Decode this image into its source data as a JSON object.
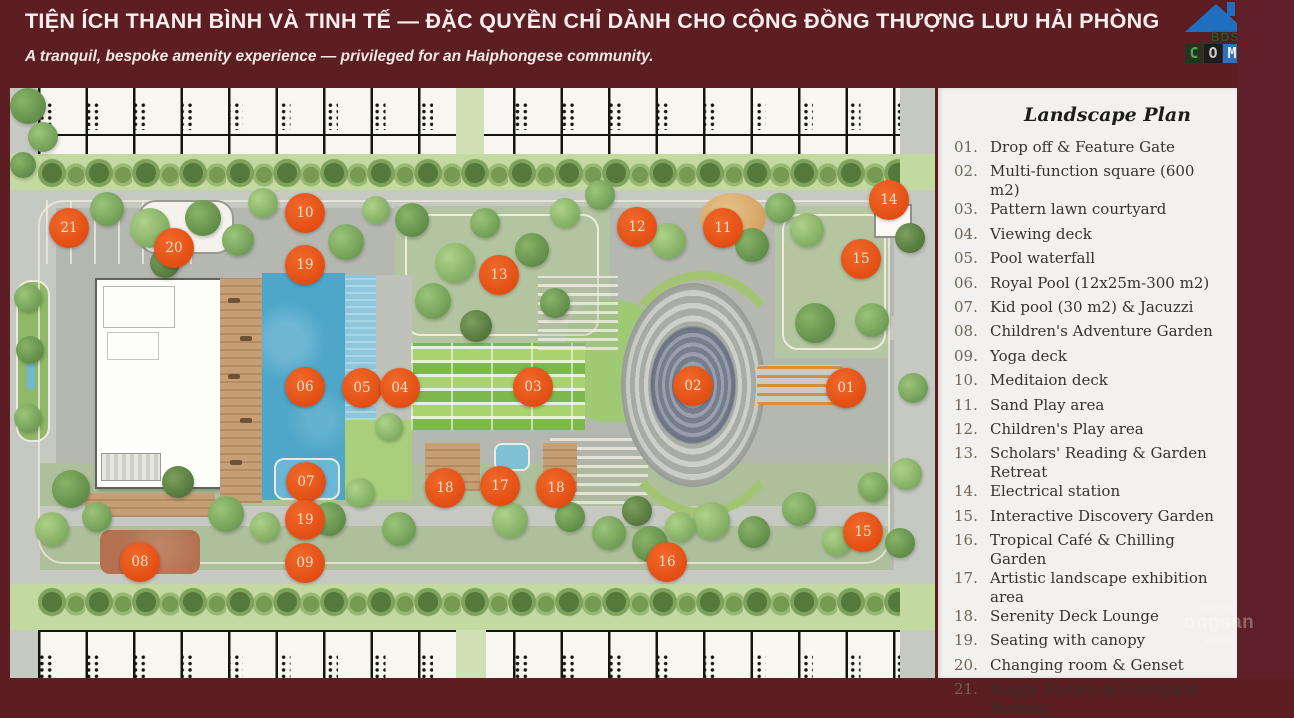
{
  "header": {
    "title": "TIỆN ÍCH THANH BÌNH VÀ TINH TẾ — ĐẶC QUYỀN CHỈ DÀNH CHO CỘNG ĐỒNG THƯỢNG LƯU HẢI PHÒNG",
    "subtitle": "A tranquil, bespoke amenity experience — privileged for an Haiphongese community.",
    "logo": {
      "bds": "BDS",
      "c": "C",
      "o": "O",
      "m": "M"
    }
  },
  "legend": {
    "title": "Landscape Plan",
    "items": [
      {
        "num": "01.",
        "label": "Drop off & Feature Gate"
      },
      {
        "num": "02.",
        "label": "Multi-function square (600 m2)"
      },
      {
        "num": "03.",
        "label": "Pattern lawn courtyard"
      },
      {
        "num": "04.",
        "label": "Viewing deck"
      },
      {
        "num": "05.",
        "label": "Pool waterfall"
      },
      {
        "num": "06.",
        "label": "Royal Pool (12x25m-300 m2)"
      },
      {
        "num": "07.",
        "label": "Kid pool (30 m2) & Jacuzzi"
      },
      {
        "num": "08.",
        "label": "Children's Adventure Garden"
      },
      {
        "num": "09.",
        "label": "Yoga deck"
      },
      {
        "num": "10.",
        "label": "Meditaion deck"
      },
      {
        "num": "11.",
        "label": "Sand Play area"
      },
      {
        "num": "12.",
        "label": "Children's Play area"
      },
      {
        "num": "13.",
        "label": "Scholars' Reading & Garden Retreat"
      },
      {
        "num": "14.",
        "label": "Electrical station"
      },
      {
        "num": "15.",
        "label": "Interactive Discovery Garden"
      },
      {
        "num": "16.",
        "label": "Tropical Café & Chilling Garden"
      },
      {
        "num": "17.",
        "label": "Artistic landscape exhibition area"
      },
      {
        "num": "18.",
        "label": "Serenity Deck Lounge"
      },
      {
        "num": "19.",
        "label": "Seating with canopy"
      },
      {
        "num": "20.",
        "label": "Changing room & Genset"
      },
      {
        "num": "21.",
        "label": "Buggy Station & Courtyard Parking"
      }
    ]
  },
  "plan": {
    "markers": [
      "21",
      "20",
      "10",
      "19",
      "13",
      "12",
      "11",
      "14",
      "15",
      "06",
      "05",
      "04",
      "03",
      "02",
      "01",
      "07",
      "18",
      "17",
      "18",
      "19",
      "15",
      "08",
      "09",
      "16"
    ]
  },
  "watermark": {
    "top": "zoanurr",
    "main": "ongsan",
    "sub": "yGuru"
  },
  "colors": {
    "maroon": "#5c1d23",
    "marker_orange": "#e1490f",
    "pool_blue": "#4ea6c9",
    "logo_blue": "#1f6fbe"
  }
}
